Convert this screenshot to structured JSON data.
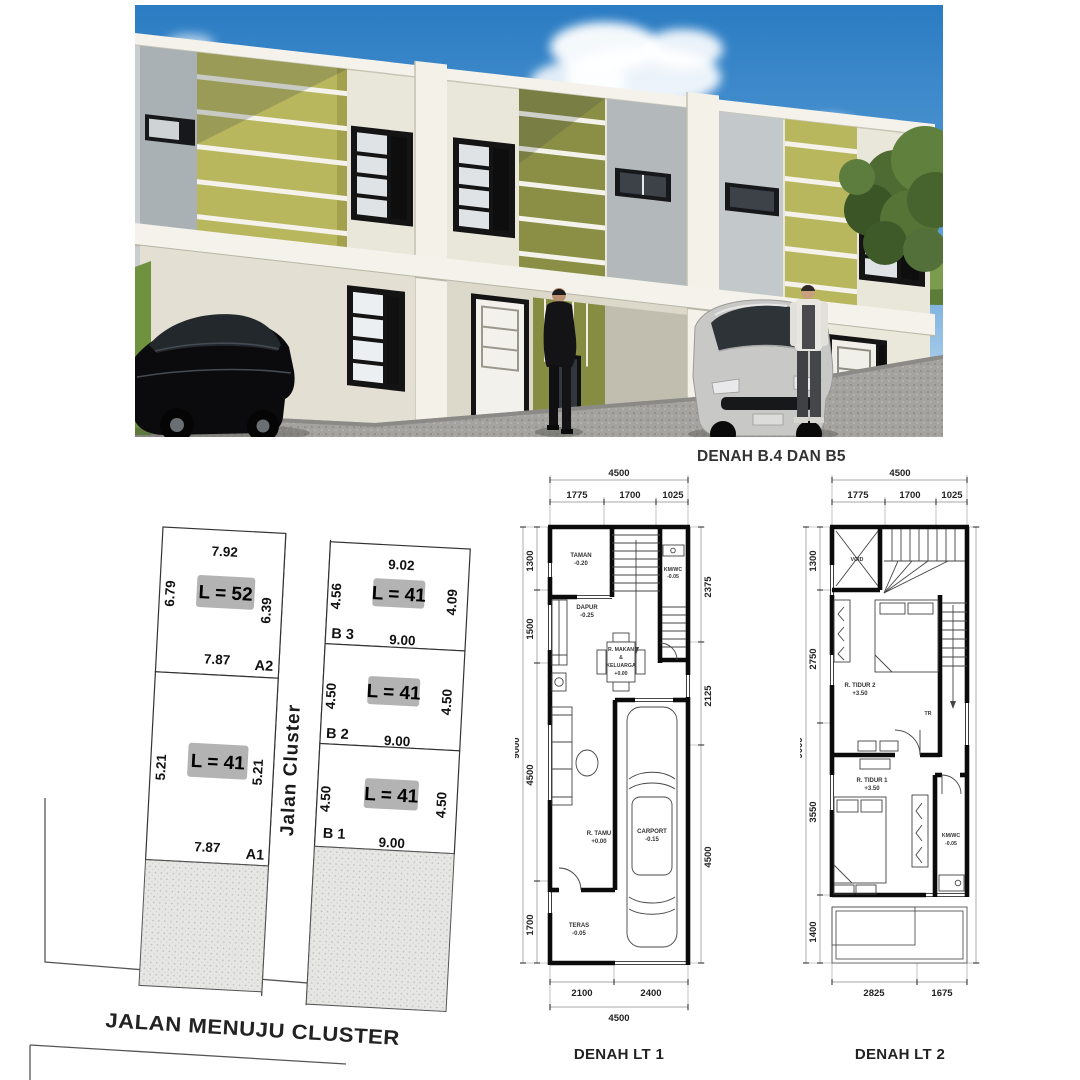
{
  "render": {
    "description": "3d-exterior-render-of-three-two-storey-townhouse-units",
    "colors": {
      "sky": "#2f7fc5",
      "olive_accent": "#b9b75e",
      "olive_dark": "#8a8f45",
      "wall_cream": "#eae7db",
      "pavement_gray": "#a2a19d"
    }
  },
  "site_plan": {
    "road_label": "JALAN MENUJU CLUSTER",
    "street_label": "Jalan Cluster",
    "lots": {
      "a2": {
        "id": "A2",
        "area": "L = 52",
        "top": "7.92",
        "left": "6.79",
        "right": "6.39",
        "bottom": "7.87"
      },
      "a1": {
        "id": "A1",
        "area": "L = 41",
        "left": "5.21",
        "right": "5.21",
        "bottom": "7.87"
      },
      "b3": {
        "id": "B 3",
        "area": "L = 41",
        "top": "9.02",
        "left": "4.56",
        "right": "4.09",
        "bottom": "9.00"
      },
      "b2": {
        "id": "B 2",
        "area": "L = 41",
        "left": "4.50",
        "right": "4.50",
        "bottom": "9.00"
      },
      "b1": {
        "id": "B 1",
        "area": "L = 41",
        "left": "4.50",
        "right": "4.50",
        "bottom": "9.00"
      }
    }
  },
  "plans": {
    "header": "DENAH B.4 DAN B5",
    "lt1": {
      "title": "DENAH LT 1",
      "dims": {
        "top_total": "4500",
        "top": [
          "1775",
          "1700",
          "1025"
        ],
        "left_total": "9000",
        "left": [
          "1300",
          "1500",
          "4500",
          "1700"
        ],
        "right": [
          "2375",
          "2125",
          "4500"
        ],
        "bottom": [
          "2100",
          "2400"
        ],
        "bottom_total": "4500"
      },
      "rooms": {
        "taman": {
          "name": "TAMAN",
          "level": "-0.20"
        },
        "dapur": {
          "name": "DAPUR",
          "level": "-0.25"
        },
        "kmwc": {
          "name": "KM/WC",
          "level": "-0.05"
        },
        "makan": {
          "line1": "R. MAKAN",
          "line2": "&",
          "line3": "KELUARGA",
          "level": "+0.00"
        },
        "tamu": {
          "name": "R. TAMU",
          "level": "+0.00"
        },
        "carport": {
          "name": "CARPORT",
          "level": "-0.15"
        },
        "teras": {
          "name": "TERAS",
          "level": "-0.05"
        },
        "stair_note": "NK"
      }
    },
    "lt2": {
      "title": "DENAH LT 2",
      "dims": {
        "top_total": "4500",
        "top": [
          "1775",
          "1700",
          "1025"
        ],
        "left_total": "9000",
        "left": [
          "1300",
          "2750",
          "3550",
          "1400"
        ],
        "bottom": [
          "2825",
          "1675"
        ]
      },
      "rooms": {
        "void": {
          "name": "VOID"
        },
        "tidur2": {
          "name": "R. TIDUR 2",
          "level": "+3.50"
        },
        "tidur1": {
          "name": "R. TIDUR 1",
          "level": "+3.50"
        },
        "kmwc": {
          "name": "KM/WC",
          "level": "-0.05"
        },
        "stair_note": "TR"
      }
    }
  }
}
